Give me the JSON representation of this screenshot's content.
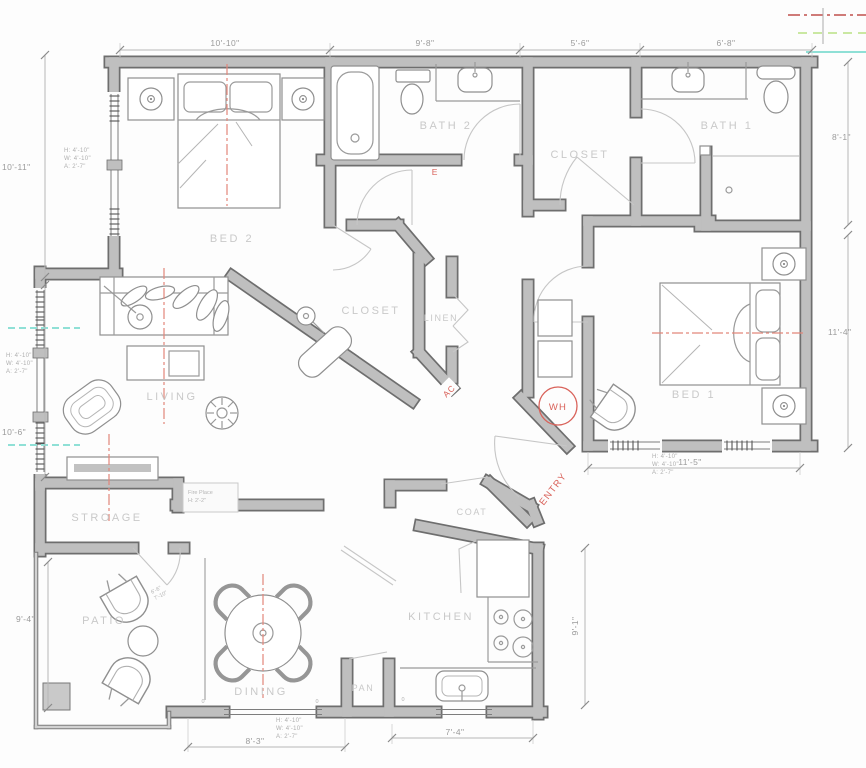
{
  "labels": {
    "bed2": "BED 2",
    "bath2": "BATH 2",
    "closet_top": "CLOSET",
    "bath1": "BATH 1",
    "bed1": "BED 1",
    "closet_mid": "CLOSET",
    "linen": "LINEN",
    "living": "LIVING",
    "storage": "STROAGE",
    "coat": "COAT",
    "kitchen": "KITCHEN",
    "pantry": "PAN",
    "dining": "DINING",
    "patio": "PATIO"
  },
  "red_labels": {
    "entry": "ENTRY",
    "water_heater": "WH",
    "ac": "AC",
    "electrical": "E"
  },
  "dimensions": {
    "top": [
      "10'-10\"",
      "9'-8\"",
      "5'-6\"",
      "6'-8\""
    ],
    "left": [
      "10'-11\"",
      "10'-6\"",
      "9'-4\""
    ],
    "right": [
      "8'-1\"",
      "11'-4\"",
      "9'-1\""
    ],
    "bottom": [
      "8'-3\"",
      "7'-4\""
    ],
    "bed1_interior": "11'-5\""
  },
  "window_annotation": {
    "height": "H: 4'-10\"",
    "width": "W: 4'-10\"",
    "area": "A: 2'-7\""
  },
  "fireplace_note": {
    "line1": "Fire Place",
    "line2": "H: 2'-2\""
  },
  "patio_annotation": {
    "line1": "6'-6\"",
    "line2": "7'-10\""
  },
  "door_marks": {
    "zero": "0"
  },
  "colors": {
    "wall_fill": "#bfbfbf",
    "wall_edge": "#6e6e6e",
    "room_label": "#c9c9c9",
    "dimension_text": "#9b9b9b",
    "red_accent": "#d9625a",
    "centerline": "#e2867a",
    "cyan_marker": "#8fe0d6",
    "green_marker": "#b9e184",
    "dark_red_marker": "#c0504d"
  }
}
